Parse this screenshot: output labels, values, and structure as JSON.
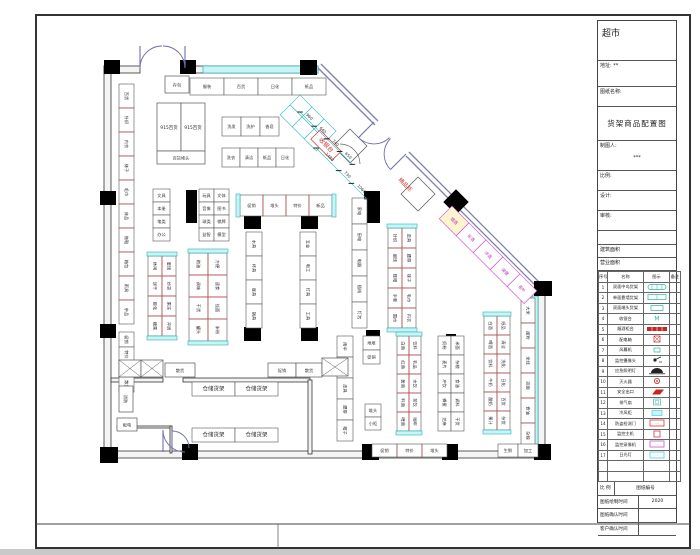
{
  "title_block": {
    "store_name": "超市",
    "addr_label": "地址:",
    "addr_value": "**",
    "sheet_name_label": "图纸名称:",
    "drawing_title": "货架商品配置图",
    "drafter_label": "制图人:",
    "drafter_value": "***",
    "simple_rows": [
      {
        "label": "比例:",
        "cls": ""
      },
      {
        "label": "设计:",
        "cls": ""
      },
      {
        "label": "审核:",
        "cls": ""
      },
      {
        "label": "",
        "cls": "s"
      },
      {
        "label": "建筑面积",
        "cls": "t"
      },
      {
        "label": "营业面积",
        "cls": "t"
      }
    ],
    "footer_rows": [
      {
        "label": "比 例",
        "value": "图纸编号"
      },
      {
        "label": "图纸绘制时间",
        "value": "2020"
      },
      {
        "label": "图纸确认时间",
        "value": ""
      },
      {
        "label": "客户确认时间",
        "value": ""
      }
    ]
  },
  "legend": {
    "headers": [
      "序号",
      "名称",
      "图示",
      "备注"
    ],
    "rows": [
      {
        "no": "1",
        "name": "双面中岛货架",
        "icon": "pill",
        "color": "#2ab5a5"
      },
      {
        "no": "2",
        "name": "单面靠墙货架",
        "icon": "rect",
        "color": "#2ab5a5"
      },
      {
        "no": "3",
        "name": "双面端头货架",
        "icon": "rect-s",
        "color": "#2ab5a5"
      },
      {
        "no": "4",
        "name": "收银台",
        "icon": "M",
        "color": "#2ab5a5"
      },
      {
        "no": "5",
        "name": "烟酒柜台",
        "icon": "bar",
        "color": "#cc2222"
      },
      {
        "no": "6",
        "name": "配电箱",
        "icon": "boxx",
        "color": "#cc2222"
      },
      {
        "no": "7",
        "name": "风幕机",
        "icon": "box-s",
        "color": "#2ab5a5"
      },
      {
        "no": "8",
        "name": "监控摄像头",
        "icon": "cam",
        "color": "#222222"
      },
      {
        "no": "9",
        "name": "应急照明灯",
        "icon": "lamp",
        "color": "#222222"
      },
      {
        "no": "10",
        "name": "灭火器",
        "icon": "circle",
        "color": "#cc2222"
      },
      {
        "no": "11",
        "name": "安全出口",
        "icon": "para",
        "color": "#cc2222"
      },
      {
        "no": "12",
        "name": "排气扇",
        "icon": "fan",
        "color": "#2ab5a5"
      },
      {
        "no": "13",
        "name": "冷风柜",
        "icon": "boxfill",
        "color": "#35c8d8"
      },
      {
        "no": "14",
        "name": "防盗检测门",
        "icon": "boxo",
        "color": "#cc2222"
      },
      {
        "no": "15",
        "name": "监控主机",
        "icon": "boxo-s",
        "color": "#cc2222"
      },
      {
        "no": "16",
        "name": "监控录像机",
        "icon": "boxo",
        "color": "#bb44bb"
      },
      {
        "no": "17",
        "name": "日光灯",
        "icon": "boxo",
        "color": "#35c8d8"
      },
      {
        "no": "",
        "name": "",
        "icon": "",
        "color": ""
      },
      {
        "no": "",
        "name": "",
        "icon": "",
        "color": ""
      }
    ]
  },
  "plan": {
    "frame": {
      "x": 36,
      "y": 15,
      "w": 654,
      "h": 533,
      "strip_y": 524,
      "strip_div_x": 278
    },
    "walls": [
      {
        "x": 104,
        "y": 66,
        "w": 36,
        "h": 7
      },
      {
        "x": 185,
        "y": 66,
        "w": 133,
        "h": 7
      },
      {
        "x": 104,
        "y": 66,
        "w": 7,
        "h": 392
      },
      {
        "x": 538,
        "y": 292,
        "w": 7,
        "h": 166
      },
      {
        "x": 104,
        "y": 451,
        "w": 441,
        "h": 7
      },
      {
        "x": 111,
        "y": 378,
        "w": 52,
        "h": 4
      },
      {
        "x": 183,
        "y": 378,
        "w": 127,
        "h": 4
      },
      {
        "x": 308,
        "y": 380,
        "w": 4,
        "h": 74
      },
      {
        "x": 117,
        "y": 426,
        "w": 55,
        "h": 2
      },
      {
        "x": 170,
        "y": 426,
        "w": 2,
        "h": 27
      }
    ],
    "diag_walls": [
      {
        "x1": 318,
        "y1": 68,
        "x2": 375,
        "y2": 125
      },
      {
        "x1": 321,
        "y1": 64,
        "x2": 378,
        "y2": 121
      },
      {
        "x1": 406,
        "y1": 156,
        "x2": 542,
        "y2": 292
      },
      {
        "x1": 409,
        "y1": 152,
        "x2": 545,
        "y2": 288
      }
    ],
    "strips": [
      {
        "x": 203,
        "y": 66,
        "w": 115,
        "h": 7
      },
      {
        "x": 532,
        "y": 296,
        "w": 6,
        "h": 152
      }
    ],
    "columns": [
      [
        104,
        60,
        16,
        14
      ],
      [
        180,
        60,
        16,
        14
      ],
      [
        300,
        60,
        17,
        15
      ],
      [
        100,
        191,
        16,
        14
      ],
      [
        100,
        324,
        16,
        14
      ],
      [
        100,
        447,
        18,
        16
      ],
      [
        182,
        444,
        16,
        16
      ],
      [
        244,
        215,
        17,
        14
      ],
      [
        301,
        215,
        17,
        14
      ],
      [
        244,
        327,
        17,
        14
      ],
      [
        301,
        327,
        17,
        14
      ],
      [
        362,
        444,
        17,
        16
      ],
      [
        442,
        444,
        16,
        16
      ],
      [
        534,
        281,
        18,
        15
      ],
      [
        534,
        444,
        17,
        16
      ],
      [
        186,
        190,
        11,
        33
      ],
      [
        364,
        191,
        16,
        32
      ],
      [
        446,
        334,
        10,
        92
      ],
      [
        366,
        330,
        14,
        14
      ]
    ],
    "diamond": {
      "cx": 456,
      "cy": 202,
      "s": 18
    },
    "runs": [
      {
        "x": 190,
        "y": 78,
        "c": 4,
        "r": 1,
        "cw": 34,
        "ch": 17,
        "lab": [
          "服装",
          "百货",
          "日化",
          "纸品"
        ]
      },
      {
        "x": 222,
        "y": 117,
        "c": 3,
        "r": 1,
        "cw": 19,
        "ch": 19,
        "lab": [
          "洗发",
          "洗护",
          "香皂"
        ]
      },
      {
        "x": 222,
        "y": 148,
        "c": 4,
        "r": 1,
        "cw": 18,
        "ch": 19,
        "lab": [
          "洗衣",
          "清洁",
          "纸品",
          "日化"
        ]
      },
      {
        "x": 119,
        "y": 84,
        "c": 1,
        "r": 10,
        "cw": 15,
        "ch": 24,
        "d": "#c05050",
        "lr": 1,
        "lab": [
          "百货",
          "针织",
          "内衣",
          "袜子",
          "毛巾",
          "床品",
          "拖鞋",
          "箱包",
          "雨具",
          "杂品"
        ]
      },
      {
        "x": 119,
        "y": 332,
        "c": 1,
        "r": 4,
        "cw": 15,
        "ch": 15,
        "lr": 1,
        "lab": [
          "促销",
          "特价",
          "堆头",
          "散货"
        ]
      },
      {
        "x": 153,
        "y": 189,
        "c": 1,
        "r": 4,
        "cw": 17,
        "ch": 13,
        "lab": [
          "文具",
          "本册",
          "笔类",
          "办公"
        ]
      },
      {
        "x": 199,
        "y": 189,
        "c": 2,
        "r": 4,
        "cw": 15,
        "ch": 13,
        "lab": [
          "玩具",
          "文体",
          "音像",
          "图书",
          "球类",
          "棋牌",
          "益智",
          "模型"
        ]
      },
      {
        "x": 148,
        "y": 256,
        "c": 2,
        "r": 4,
        "cw": 14,
        "ch": 20,
        "cap": "v",
        "d": "#c05050",
        "lr": 1,
        "lab": [
          "休闲",
          "饼干",
          "膨化",
          "糖果",
          "蜜饯",
          "炒货",
          "果冻",
          "冲调"
        ]
      },
      {
        "x": 189,
        "y": 253,
        "c": 2,
        "r": 4,
        "cw": 19,
        "ch": 22,
        "cap": "v",
        "d": "#c05050",
        "lr": 1,
        "lab": [
          "粮油",
          "调味",
          "干货",
          "罐头",
          "方便",
          "速食",
          "挂面",
          "米粉"
        ]
      },
      {
        "x": 240,
        "y": 195,
        "c": 4,
        "r": 1,
        "cw": 23,
        "ch": 21,
        "cap": "h",
        "d": "#c05050",
        "lab": [
          "促销",
          "堆头",
          "特价",
          "新品"
        ]
      },
      {
        "x": 246,
        "y": 232,
        "c": 1,
        "r": 4,
        "cw": 16,
        "ch": 24,
        "lr": 1,
        "lab": [
          "水具",
          "杯具",
          "餐具",
          "锅具"
        ]
      },
      {
        "x": 300,
        "y": 232,
        "c": 1,
        "r": 4,
        "cw": 16,
        "ch": 24,
        "lr": 1,
        "lab": [
          "五金",
          "电工",
          "灯具",
          "工具"
        ]
      },
      {
        "x": 352,
        "y": 198,
        "c": 1,
        "r": 5,
        "cw": 15,
        "ch": 26,
        "lr": 1,
        "lab": [
          "家电",
          "厨电",
          "电器",
          "插线",
          "灯泡"
        ]
      },
      {
        "x": 388,
        "y": 228,
        "c": 2,
        "r": 5,
        "cw": 14,
        "ch": 20,
        "cap": "v",
        "d": "#c05050",
        "lr": 1,
        "lab": [
          "针织",
          "服饰",
          "鞋帽",
          "手套",
          "围巾",
          "皮具",
          "腰带",
          "袜子",
          "毛巾",
          "内衣"
        ]
      },
      {
        "x": 337,
        "y": 336,
        "c": 1,
        "r": 5,
        "cw": 16,
        "ch": 21,
        "lr": 1,
        "lab": [
          "雨伞",
          "箱包",
          "皮具",
          "腰带",
          "帽子"
        ]
      },
      {
        "x": 397,
        "y": 336,
        "c": 2,
        "r": 5,
        "cw": 12,
        "ch": 19,
        "cap": "v",
        "d": "#c05050",
        "lr": 1,
        "lab": [
          "白酒",
          "红酒",
          "黄酒",
          "料酒",
          "啤酒",
          "饮料",
          "乳品",
          "水饮",
          "茶饮",
          "咖啡"
        ]
      },
      {
        "x": 438,
        "y": 336,
        "c": 2,
        "r": 5,
        "cw": 13,
        "ch": 19,
        "lr": 1,
        "lab": [
          "奶粉",
          "麦片",
          "冲饮",
          "蜂蜜",
          "芝麻",
          "米面",
          "杂粮",
          "食油",
          "调料",
          "干货"
        ]
      },
      {
        "x": 484,
        "y": 316,
        "c": 2,
        "r": 6,
        "cw": 13,
        "ch": 19,
        "cap": "v",
        "d": "#c05050",
        "lr": 1,
        "lab": [
          "白酒",
          "啤酒",
          "饮料",
          "牛奶",
          "酸奶",
          "果汁",
          "纸品",
          "清洁",
          "洗化",
          "日化",
          "百货",
          "杂货"
        ]
      },
      {
        "x": 521,
        "y": 298,
        "c": 1,
        "r": 6,
        "cw": 14,
        "ch": 25,
        "d": "#c05050",
        "lr": 1,
        "lab": [
          "大米",
          "面粉",
          "米线",
          "挂面",
          "食油",
          "杂粮"
        ]
      },
      {
        "x": 363,
        "y": 336,
        "c": 1,
        "r": 2,
        "cw": 17,
        "ch": 14,
        "lab": [
          "地堆",
          "促销"
        ]
      },
      {
        "x": 365,
        "y": 404,
        "c": 1,
        "r": 2,
        "cw": 16,
        "ch": 13,
        "lab": [
          "堆头",
          "小柜"
        ]
      },
      {
        "x": 372,
        "y": 444,
        "c": 3,
        "r": 1,
        "cw": 25,
        "ch": 13,
        "d": "#c05050",
        "lab": [
          "促销",
          "特价",
          "堆头"
        ]
      },
      {
        "x": 498,
        "y": 444,
        "c": 2,
        "r": 1,
        "cw": 20,
        "ch": 13,
        "lab": [
          "生鲜",
          "加工"
        ]
      },
      {
        "x": 192,
        "y": 382,
        "c": 2,
        "r": 1,
        "cw": 43,
        "ch": 14,
        "fs": 5.5,
        "lab": [
          "仓储货架",
          "仓储货架"
        ]
      },
      {
        "x": 192,
        "y": 428,
        "c": 2,
        "r": 1,
        "cw": 43,
        "ch": 14,
        "fs": 5.5,
        "lab": [
          "仓储货架",
          "仓储货架"
        ]
      },
      {
        "x": 0,
        "y": 0,
        "c": 3,
        "r": 2,
        "cw": 17,
        "ch": 14,
        "s": "#30b8c0",
        "g": [
          300,
          95,
          45
        ]
      },
      {
        "x": 0,
        "y": 0,
        "c": 5,
        "r": 1,
        "cw": 24,
        "ch": 18,
        "s": "#cc44cc",
        "lc": "#bb33bb",
        "f0": "#fdf4d0",
        "lab": [
          "烟酒",
          "名酒",
          "洋酒",
          "保健",
          "茶叶"
        ],
        "g": [
          452,
          206,
          45
        ]
      }
    ],
    "boxes": [
      {
        "x": 165,
        "y": 76,
        "w": 24,
        "h": 17,
        "t": "存包"
      },
      {
        "x": 157,
        "y": 103,
        "w": 24,
        "h": 48,
        "t": "915百货",
        "fs": 4.5
      },
      {
        "x": 181,
        "y": 103,
        "w": 24,
        "h": 48,
        "t": "915百货",
        "fs": 4.5
      },
      {
        "x": 157,
        "y": 151,
        "w": 48,
        "h": 13,
        "t": "百货堆头"
      },
      {
        "x": 119,
        "y": 360,
        "w": 22,
        "h": 17,
        "diag": 1
      },
      {
        "x": 141,
        "y": 360,
        "w": 22,
        "h": 17,
        "diag": 1
      },
      {
        "x": 165,
        "y": 363,
        "w": 30,
        "h": 14,
        "t": "散货"
      },
      {
        "x": 268,
        "y": 363,
        "w": 28,
        "h": 14,
        "t": "促销"
      },
      {
        "x": 296,
        "y": 363,
        "w": 26,
        "h": 14,
        "t": "散货"
      },
      {
        "x": 322,
        "y": 358,
        "w": 26,
        "h": 18,
        "diag": 1
      },
      {
        "x": 119,
        "y": 386,
        "w": 14,
        "h": 26,
        "t": "消防",
        "lr": 1
      },
      {
        "x": 117,
        "y": 418,
        "w": 20,
        "h": 13,
        "t": "配电"
      },
      {
        "x": -12,
        "y": -12,
        "w": 24,
        "h": 24,
        "g": [
          350,
          146,
          45
        ]
      },
      {
        "x": -12,
        "y": -12,
        "w": 24,
        "h": 24,
        "g": [
          418,
          194,
          45
        ]
      },
      {
        "x": 0,
        "y": 0,
        "w": 30,
        "h": 13,
        "t": "收银台",
        "s": "#cc3333",
        "tc": "#cc3333",
        "fs": 6,
        "g": [
          320,
          130,
          45
        ]
      }
    ],
    "texts": [
      {
        "x": 404,
        "y": 186,
        "t": "精品柜",
        "c": "#cc3333",
        "fs": 5.5,
        "rot": 45
      }
    ],
    "dims": [
      {
        "g": [
          300,
          112,
          45
        ],
        "ticks": [
          0,
          20,
          38,
          56,
          74
        ],
        "labs": [
          "960",
          "640",
          "740",
          "650"
        ]
      },
      {
        "g": [
          316,
          148,
          45
        ],
        "ticks": [
          0,
          32,
          50,
          72
        ],
        "labs": [
          "1480",
          "730",
          "1060"
        ]
      }
    ],
    "doors": [
      {
        "d": "M140,68 A22,22 0 0 1 162,46",
        "leaf": "M140,68 L140,46"
      },
      {
        "d": "M185,68 A22,22 0 0 0 163,46",
        "leaf": "M185,68 L185,46"
      },
      {
        "d": "M389.5,137.5 A22,22 0 0 1 358.5,137.6",
        "leaf": "M374,122 L358.5,137.6"
      },
      {
        "d": "M390.5,138.5 A22,22 0 0 0 390.5,169.5",
        "leaf": "M406,154 L390.5,169.5"
      },
      {
        "d": "M163,430 A22,22 0 0 0 185,452",
        "leaf": "M163,452 L163,430"
      },
      {
        "d": "M172,431 A17,17 0 0 1 189,448",
        "leaf": "M172,448 L172,431"
      }
    ],
    "arcs": [
      {
        "d": "M340,144 A20,20 0 0 1 360,164",
        "c": "#666"
      }
    ]
  }
}
